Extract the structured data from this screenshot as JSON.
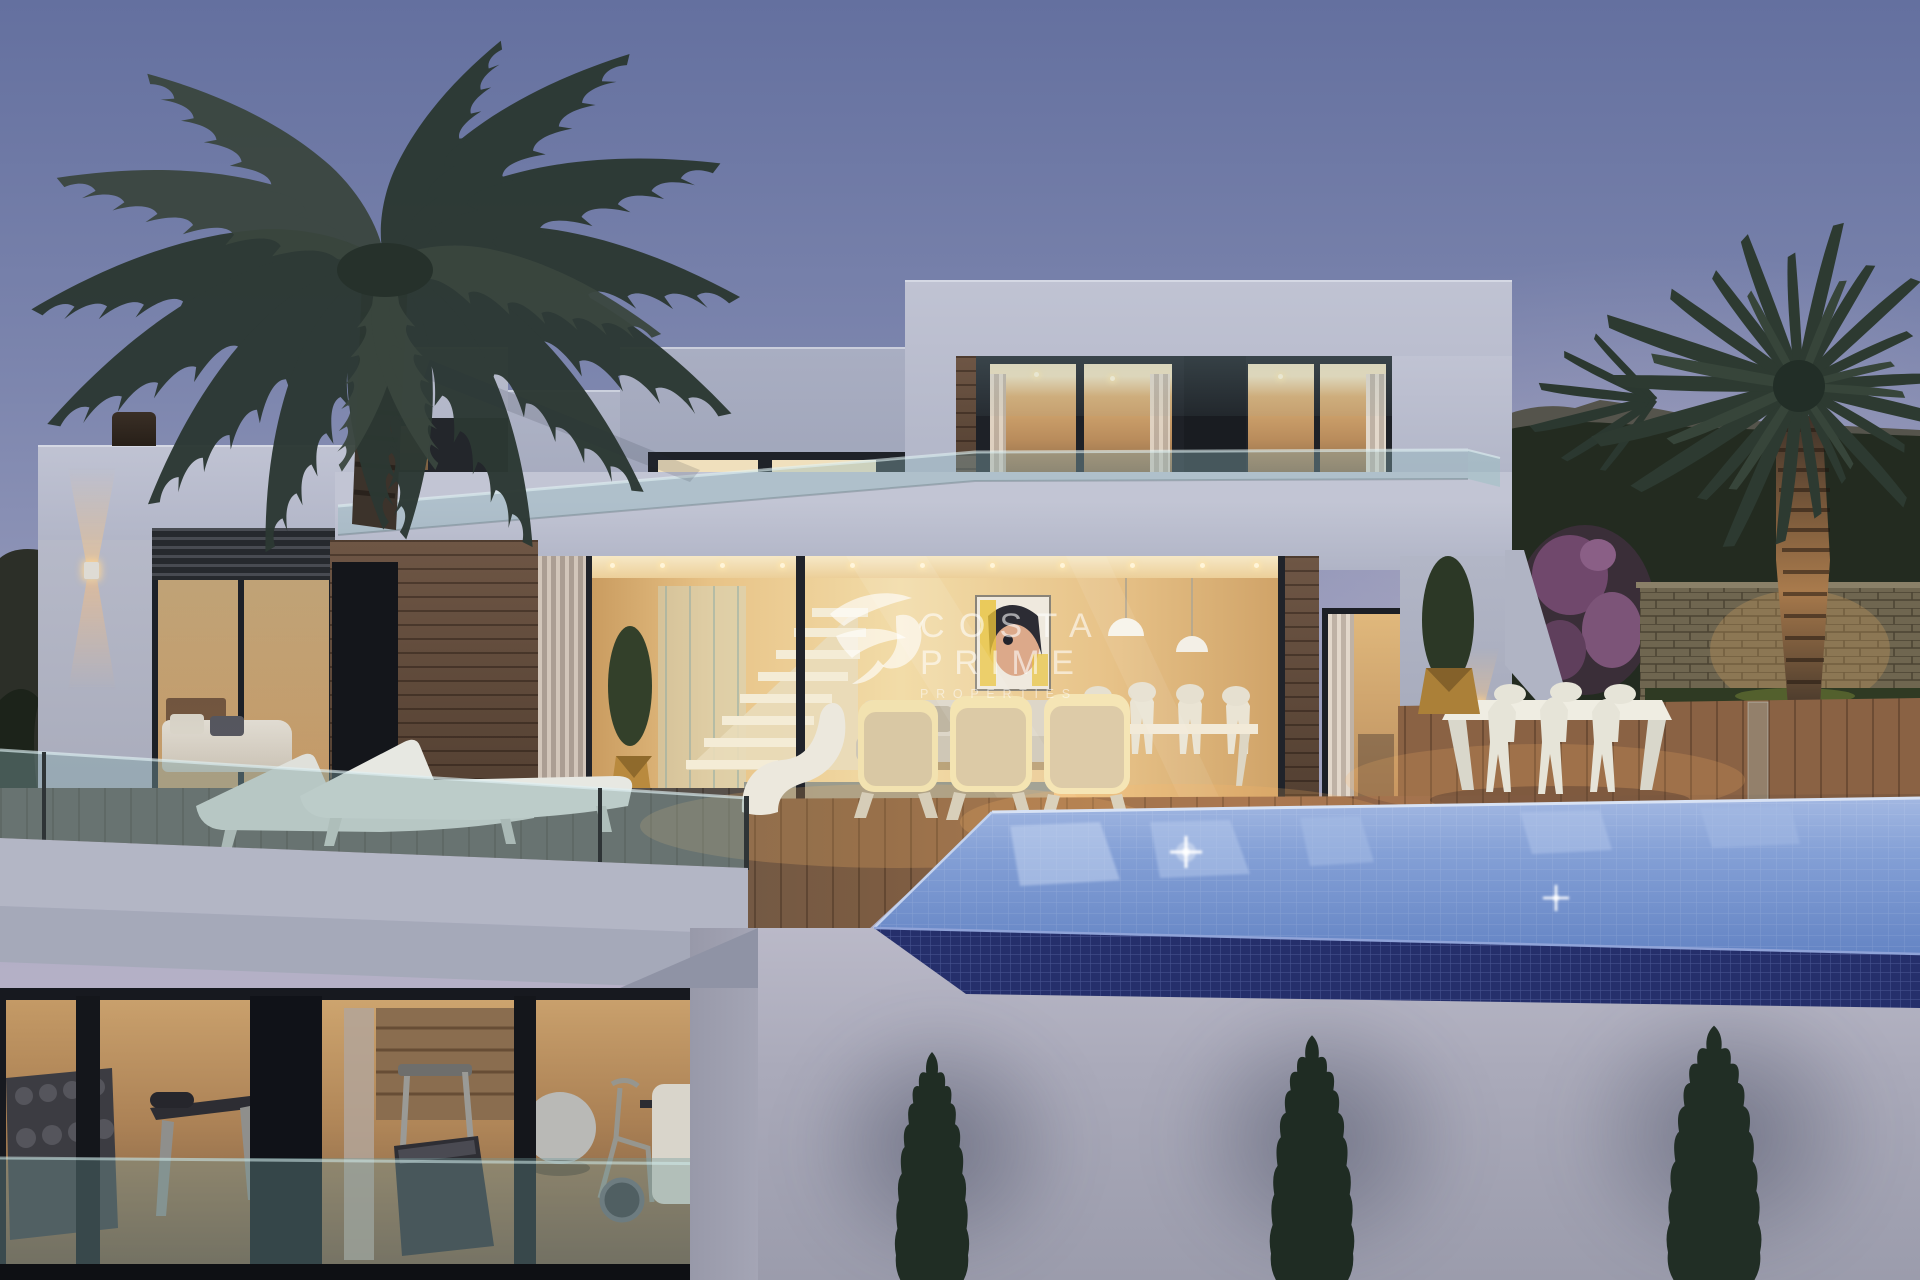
{
  "watermark": {
    "brand_line1": "COSTA",
    "brand_line2": "PRIME",
    "brand_line3": "PROPERTIES",
    "logo_icon": "hummingbird-icon",
    "color": "#ffffff"
  },
  "palette": {
    "sky_top": "#64709f",
    "sky_horizon": "#c4bbca",
    "villa_wall": "#b4b8c9",
    "window_frame_dark": "#1d2026",
    "interior_warm_light": "#e9c98f",
    "wood_cladding": "#6b5342",
    "deck_wood": "#8a6245",
    "balustrade_glass": "#86a9aa",
    "pool_water": "#7b97d0",
    "pool_tile_face": "#26316e",
    "cypress_green": "#222f26",
    "palm_silhouette": "#2e3a33",
    "stone_wall": "#7b7058",
    "lamp_glow": "#ffc882"
  }
}
